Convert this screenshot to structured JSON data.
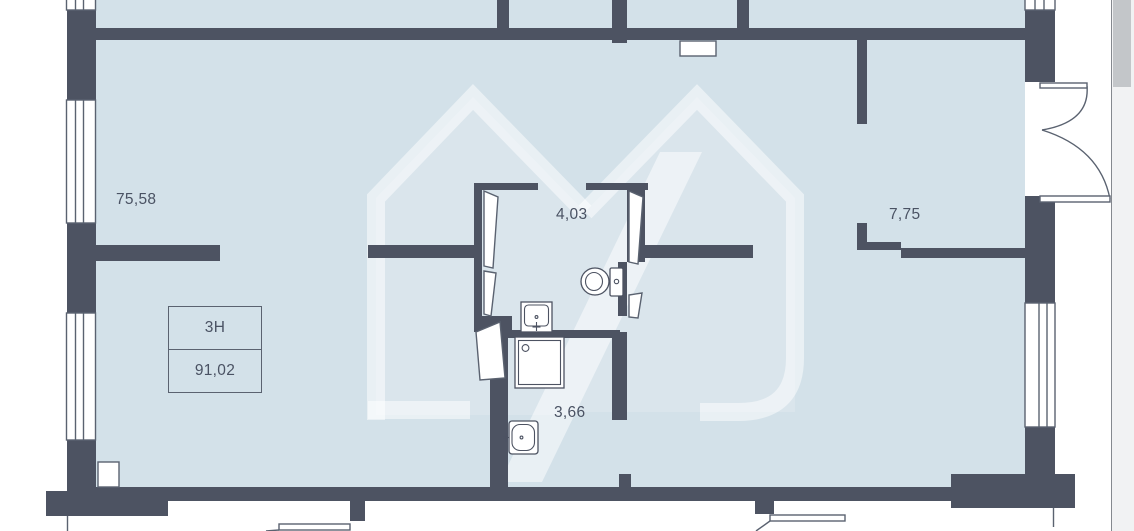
{
  "theme": {
    "page-bg": "#ffffff",
    "floor": "#d3e1e9",
    "wall": "#4d5362",
    "line": "#5a6270",
    "fixture-line": "#4d5362",
    "text": "#4a5263",
    "watermark": "#ffffff",
    "scrollbar-track": "#f1f2f3",
    "scrollbar-thumb": "#c3c6c9",
    "scrollbar-border": "#85898f"
  },
  "plan": {
    "rooms": [
      {
        "id": "main-room",
        "area_label": "75,58"
      },
      {
        "id": "bathroom",
        "area_label": "4,03"
      },
      {
        "id": "right-room",
        "area_label": "7,75"
      },
      {
        "id": "shower-room",
        "area_label": "3,66"
      }
    ],
    "unit_box": {
      "type_label": "3Н",
      "total_area_label": "91,02"
    }
  }
}
